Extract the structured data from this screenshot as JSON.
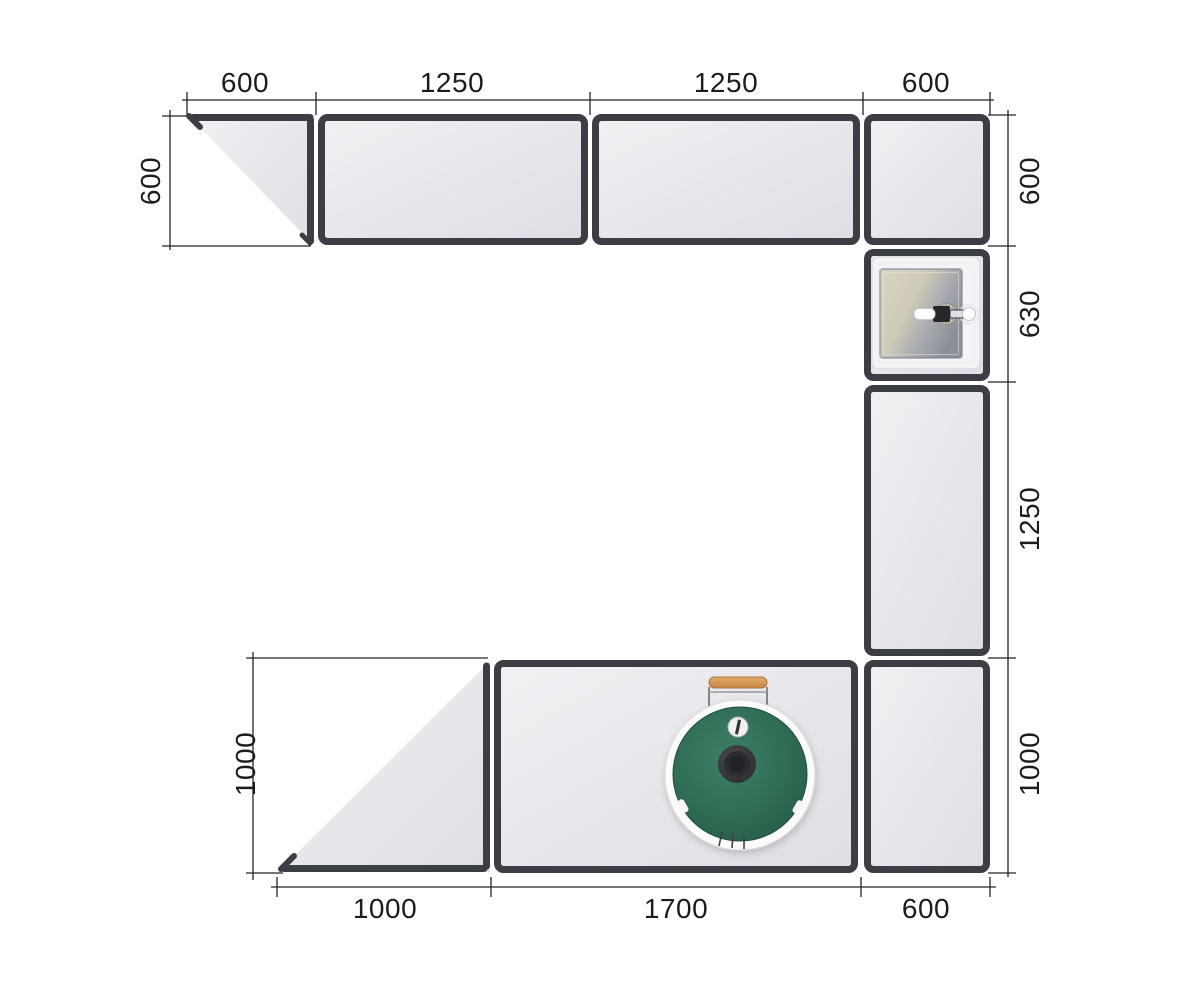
{
  "drawing_title": "kitchen-countertop-plan-top-view",
  "dimensions": {
    "top": [
      "600",
      "1250",
      "1250",
      "600"
    ],
    "right": [
      "600",
      "630",
      "1250",
      "1000"
    ],
    "bottom": [
      "1000",
      "1700",
      "600"
    ],
    "left_upper": "600",
    "left_lower": "1000"
  },
  "fixtures": {
    "sink": "sink-with-faucet-icon",
    "grill": "kamado-grill-icon"
  },
  "colors": {
    "background": "#ffffff",
    "cabinet_border": "#3b3e44",
    "cabinet_fill": "#e9e8ed",
    "dimension_line": "#232323",
    "grill_green": "#2f6d54",
    "grill_handle_wood": "#d0945a",
    "sink_basin_beige": "#d5cfbf",
    "sink_basin_shadow": "#8a9099"
  }
}
